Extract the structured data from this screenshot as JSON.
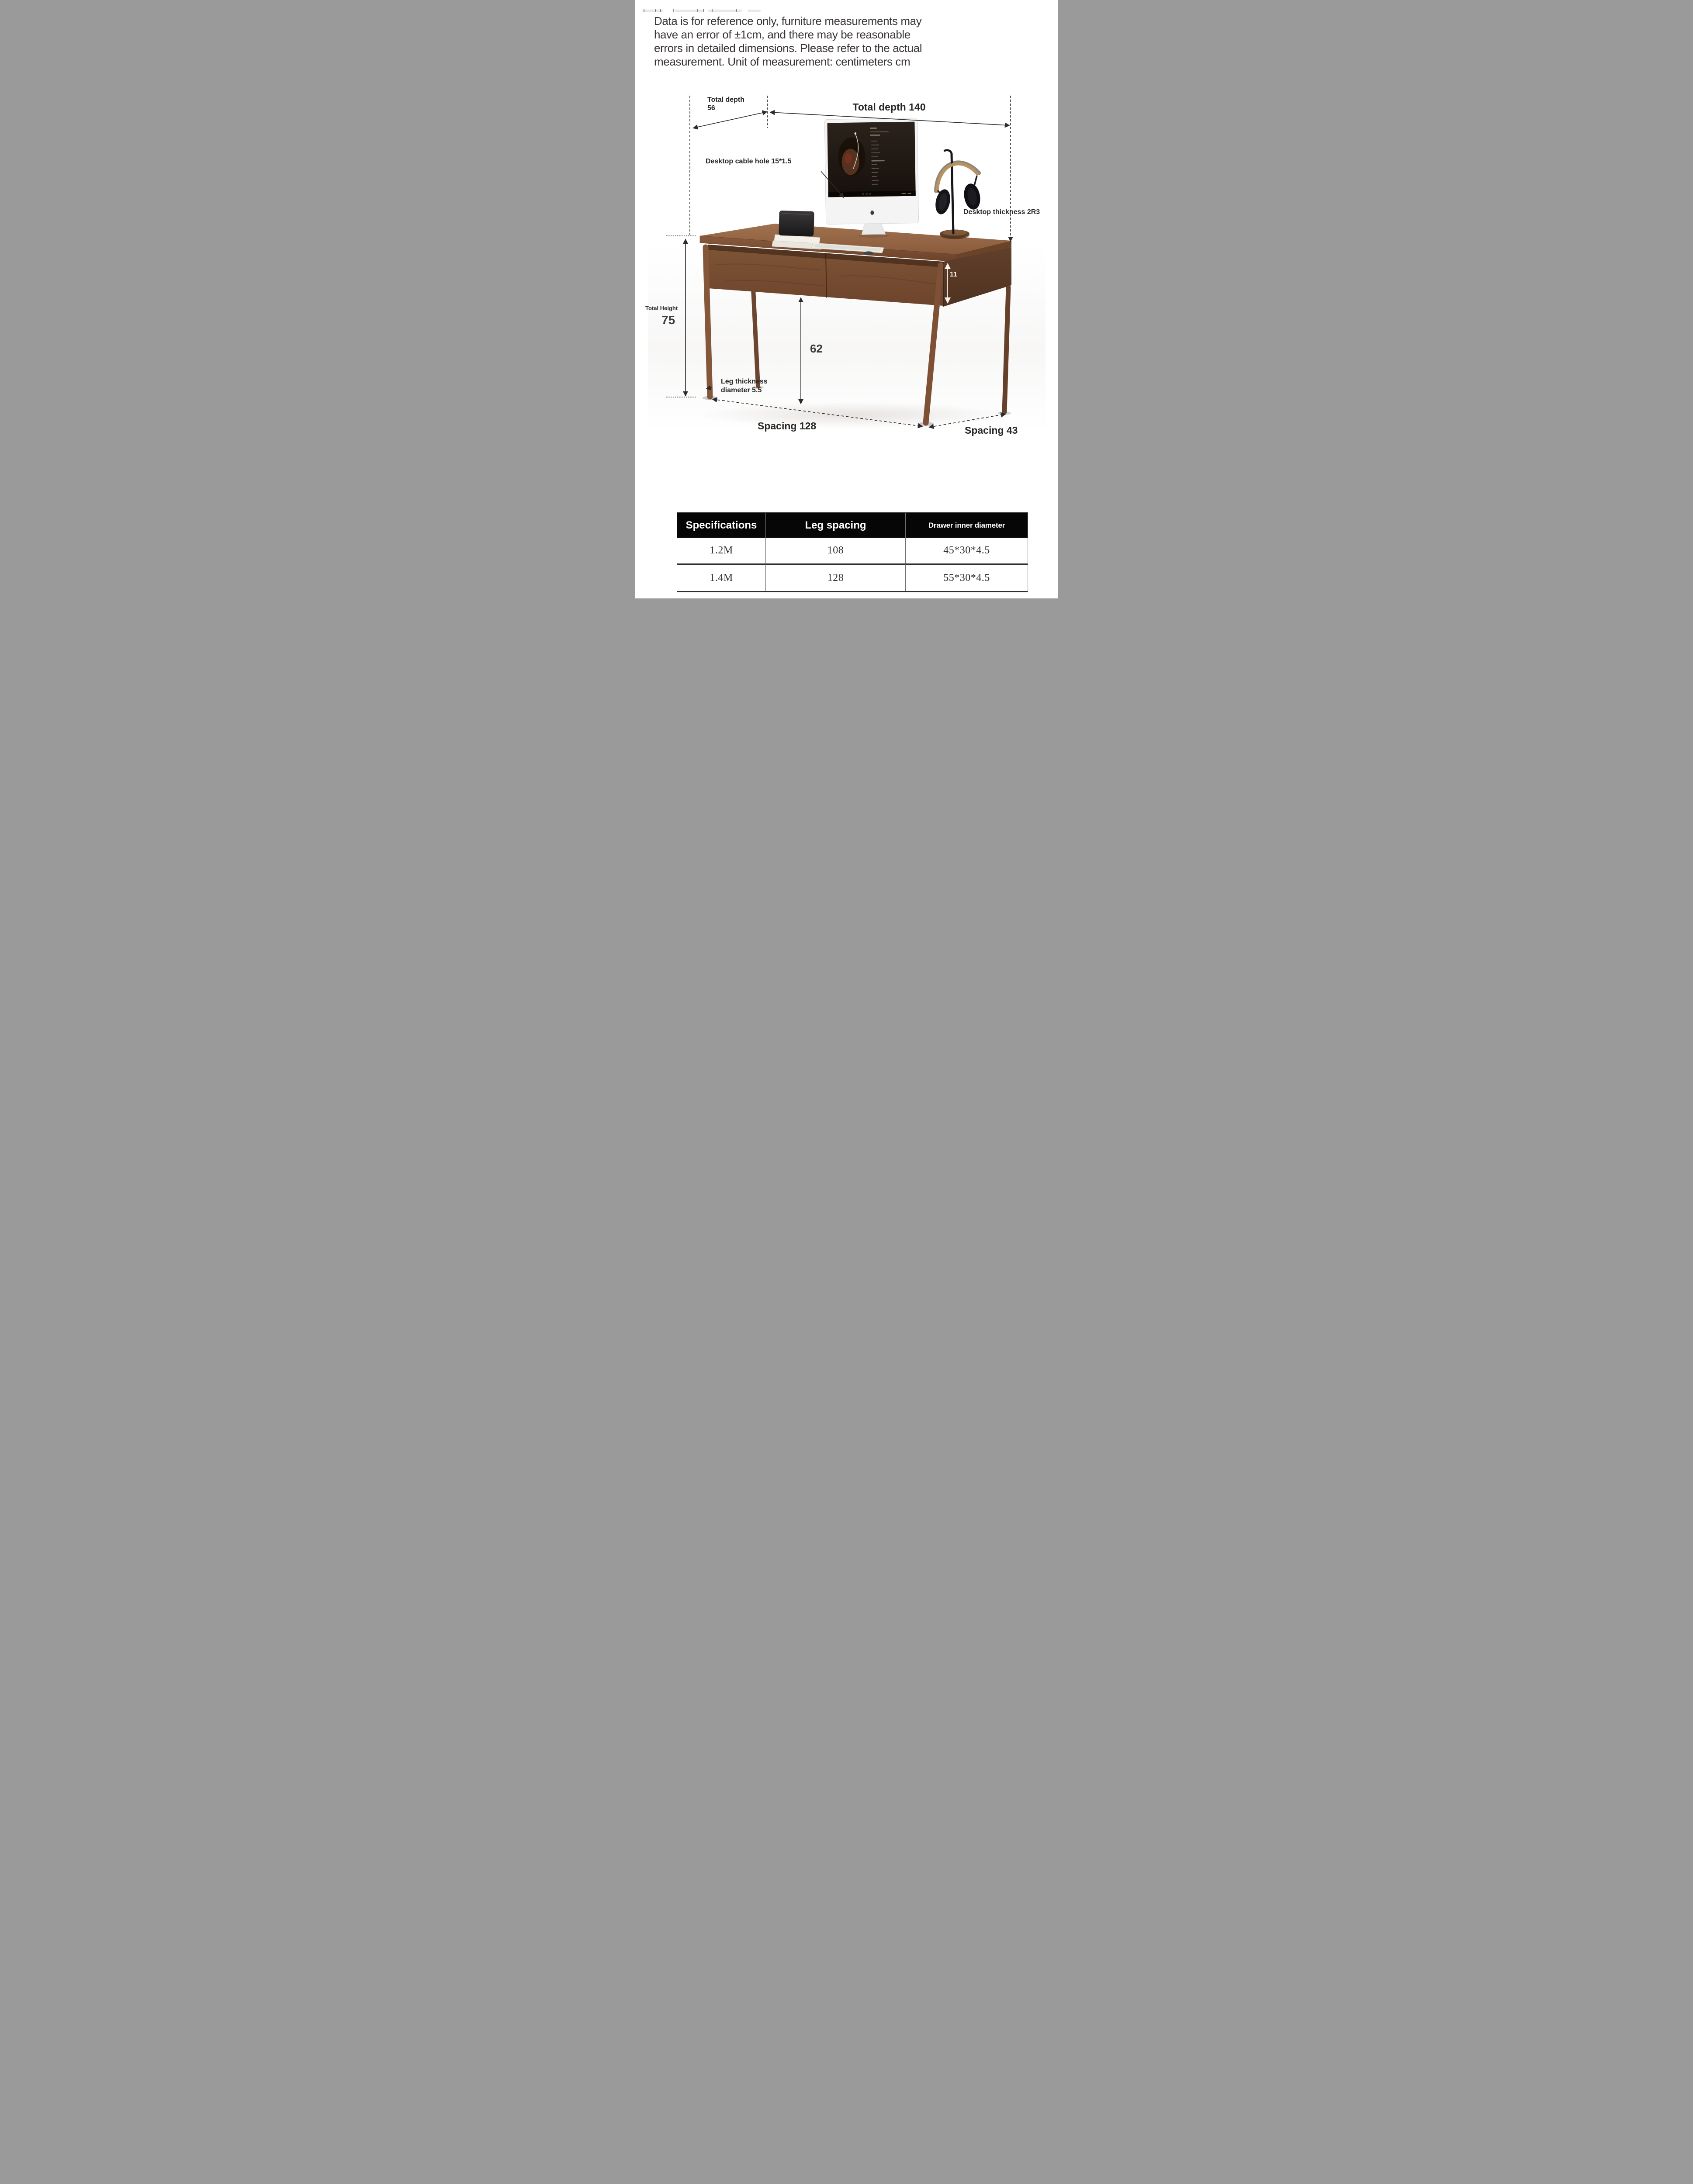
{
  "disclaimer": {
    "lines": [
      "Data is for reference only, furniture measurements may",
      "have an error of ±1cm, and there may be reasonable",
      "errors in detailed dimensions. Please refer to the actual",
      "measurement. Unit of measurement: centimeters cm"
    ]
  },
  "diagram": {
    "labels": {
      "total_depth_left": {
        "line1": "Total depth",
        "line2": "56"
      },
      "total_depth_top": "Total depth 140",
      "cable_hole": "Desktop cable hole 15*1.5",
      "desktop_thickness": "Desktop thickness 2R3",
      "drawer_height": "11",
      "total_height_title": "Total Height",
      "total_height_value": "75",
      "leg_clearance_height": "62",
      "leg_thickness": {
        "line1": "Leg thickness",
        "line2": "diameter 5.5"
      },
      "front_leg_spacing": "Spacing 128",
      "side_leg_spacing": "Spacing 43"
    },
    "colors": {
      "wood_top": "#96684a",
      "wood_front": "#7c5134",
      "wood_side": "#5d3a26",
      "wood_leg": "#85573a",
      "dimension_line": "#2b2b2b",
      "label_text": "#272727",
      "drawer_label_text": "#ffffff"
    }
  },
  "spec_table": {
    "headers": [
      "Specifications",
      "Leg spacing",
      "Drawer inner diameter"
    ],
    "rows": [
      [
        "1.2M",
        "108",
        "45*30*4.5"
      ],
      [
        "1.4M",
        "128",
        "55*30*4.5"
      ]
    ],
    "header_bg": "#060606",
    "header_text_color": "#ffffff"
  }
}
